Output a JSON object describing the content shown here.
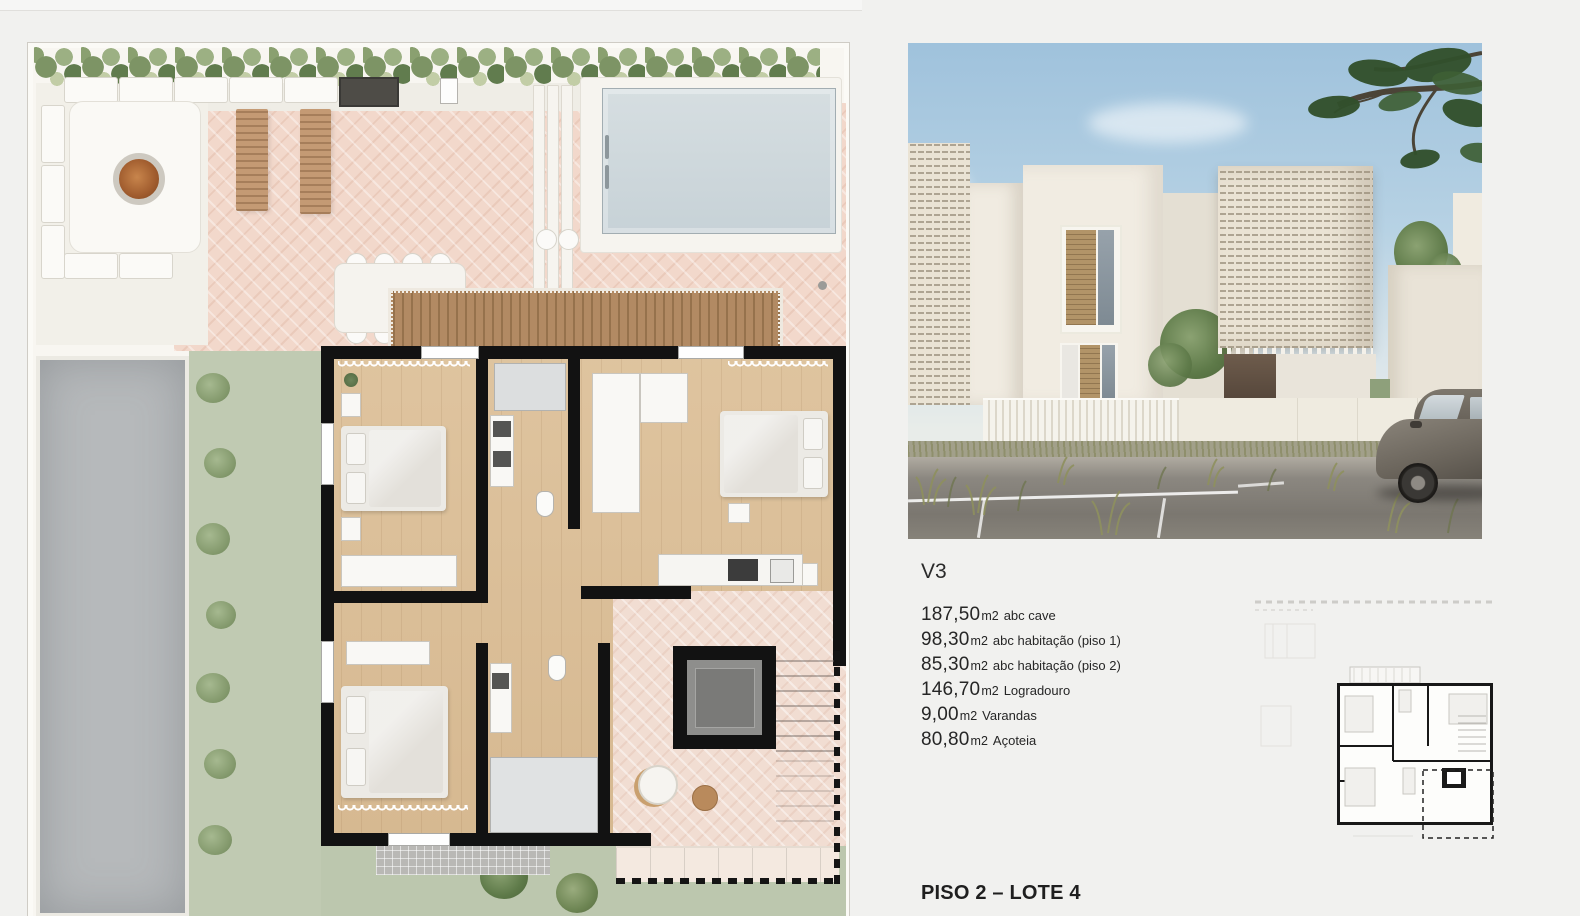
{
  "info": {
    "unit_label": "V3",
    "areas": [
      {
        "value": "187,50",
        "unit": "m2",
        "label": "abc cave"
      },
      {
        "value": "98,30",
        "unit": "m2",
        "label": "abc habitação (piso 1)"
      },
      {
        "value": "85,30",
        "unit": "m2",
        "label": "abc habitação (piso 2)"
      },
      {
        "value": "146,70",
        "unit": "m2",
        "label": "Logradouro"
      },
      {
        "value": "9,00",
        "unit": "m2",
        "label": "Varandas"
      },
      {
        "value": "80,80",
        "unit": "m2",
        "label": "Açoteia"
      }
    ],
    "floor_label": "PISO 2 – LOTE 4"
  },
  "colors": {
    "page_bg": "#f1f1ef",
    "plan_bg": "#f8f6f1",
    "patio_pink": "#f2d8cb",
    "wood_floor": "#dcbf97",
    "wall_black": "#121212",
    "pool": "#ccd7db",
    "lawn": "#bfc9b1",
    "driveway": "#b5b8ba",
    "sky": "#9fc2dc",
    "render_wall": "#efeae0",
    "road": "#817d77",
    "text": "#262626"
  }
}
